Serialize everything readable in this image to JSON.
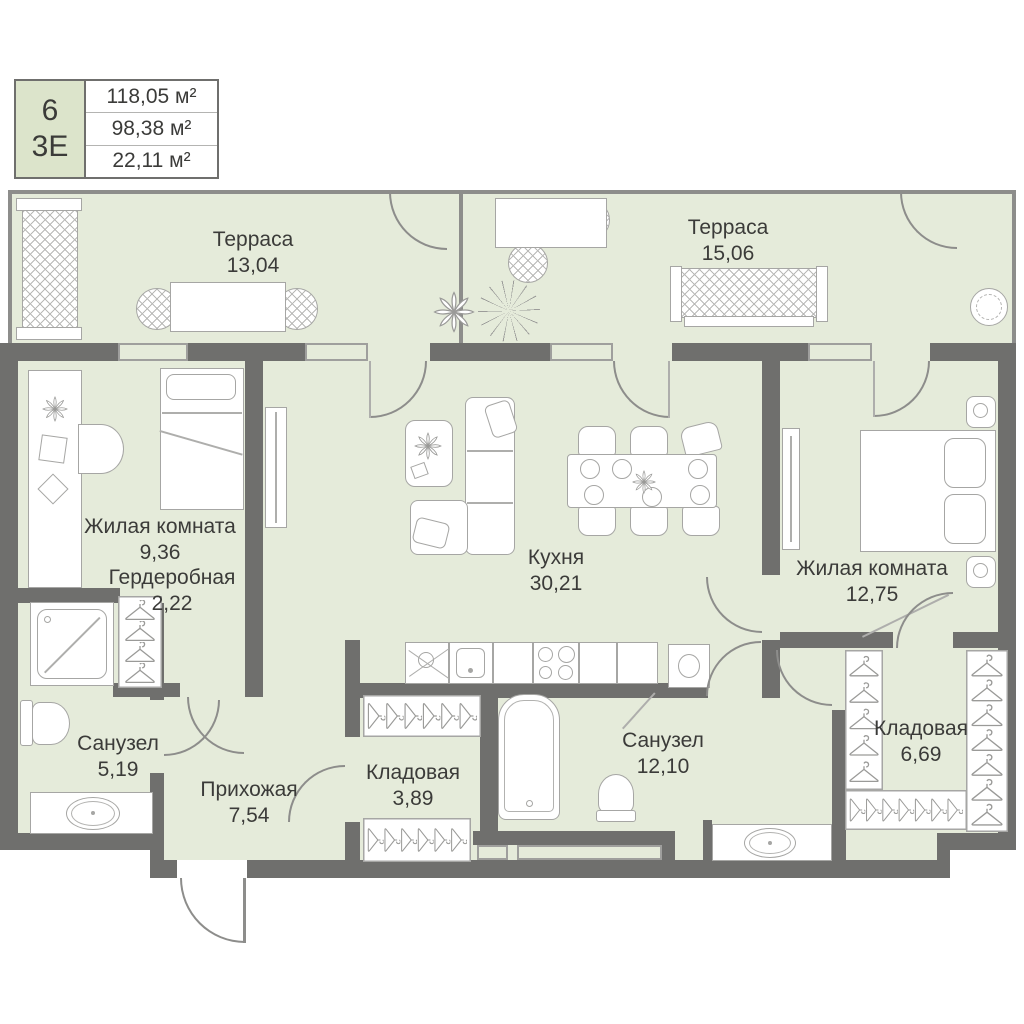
{
  "info_box": {
    "number": "6",
    "layout_code": "3Е",
    "areas": [
      "118,05 м²",
      "98,38 м²",
      "22,11 м²"
    ]
  },
  "rooms": [
    {
      "name": "Терраса",
      "area": "13,04"
    },
    {
      "name": "Терраса",
      "area": "15,06"
    },
    {
      "name": "Жилая комната",
      "area": "9,36"
    },
    {
      "name": "Гердеробная",
      "area": "2,22"
    },
    {
      "name": "Кухня",
      "area": "30,21"
    },
    {
      "name": "Жилая комната",
      "area": "12,75"
    },
    {
      "name": "Санузел",
      "area": "5,19"
    },
    {
      "name": "Прихожая",
      "area": "7,54"
    },
    {
      "name": "Кладовая",
      "area": "3,89"
    },
    {
      "name": "Санузел",
      "area": "12,10"
    },
    {
      "name": "Кладовая",
      "area": "6,69"
    }
  ],
  "colors": {
    "wall": "#6f6f6d",
    "floor": "#e5ebda",
    "outline": "#a6a6a4",
    "text": "#3b3b39",
    "info_accent_cell": "#dce4cb"
  }
}
